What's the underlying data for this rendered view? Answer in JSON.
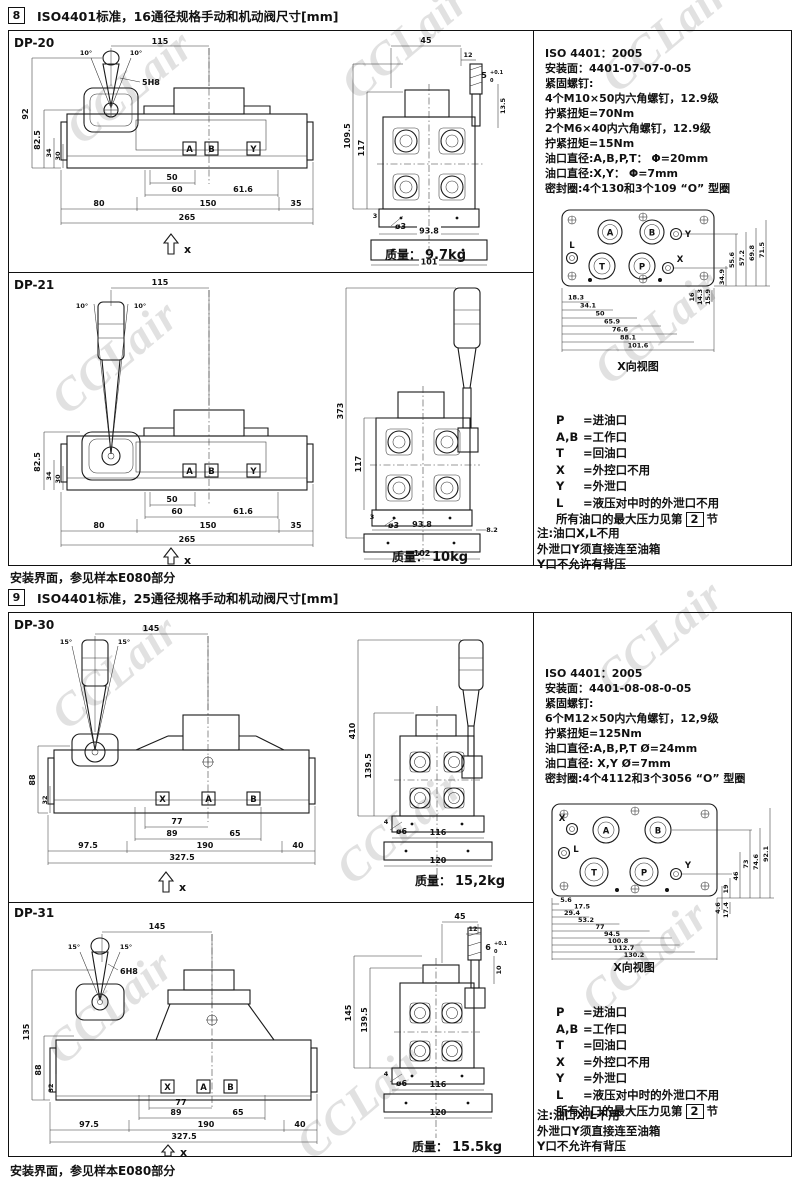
{
  "watermark": "CCLair",
  "sec8": {
    "num": "8",
    "title": "ISO4401标准，16通径规格手动和机动阀尺寸[mm]",
    "footer": "安装界面，参见样本E080部分",
    "spec": [
      "ISO 4401：2005",
      "安装面：4401-07-07-0-05",
      "紧固螺钉:",
      "4个M10×50内六角螺钉，12.9级",
      "拧紧扭矩=70Nm",
      "2个M6×40内六角螺钉，12.9级",
      "拧紧扭矩=15Nm",
      "油口直径:A,B,P,T： Φ=20mm",
      "油口直径:X,Y： Φ=7mm",
      "密封圈:4个130和3个109 “O” 型圈"
    ],
    "face": {
      "caption": "X向视图",
      "ports": [
        "L",
        "A",
        "B",
        "Y",
        "T",
        "P",
        "X"
      ],
      "hdims": [
        "18.3",
        "34.1",
        "50",
        "65.9",
        "76.6",
        "88.1",
        "101.6"
      ],
      "vdims": [
        "34.9",
        "55.6",
        "57.2",
        "69.8",
        "71.5"
      ],
      "vsmall": [
        "16",
        "14.3",
        "15.9"
      ]
    },
    "legend": {
      "rows": [
        {
          "k": "P",
          "v": "=进油口"
        },
        {
          "k": "A,B",
          "v": "=工作口"
        },
        {
          "k": "T",
          "v": "=回油口"
        },
        {
          "k": "X",
          "v": "=外控口不用"
        },
        {
          "k": "Y",
          "v": "=外泄口"
        },
        {
          "k": "L",
          "v": "=液压对中时的外泄口不用"
        }
      ],
      "max_pre": "所有油口的最大压力见第",
      "max_box": "2",
      "max_post": "节"
    },
    "note": [
      "注:油口X,L不用",
      "外泄口Y须直接连至油箱",
      "Y口不允许有背压"
    ],
    "dp20": {
      "label": "DP-20",
      "front": {
        "w115": "115",
        "a1": "10°",
        "a2": "10°",
        "pin": "5H8",
        "v92": "92",
        "v825": "82.5",
        "v34": "34",
        "v30": "30",
        "pA": "A",
        "pB": "B",
        "pY": "Y",
        "d50": "50",
        "d60": "60",
        "d616": "61.6",
        "d80": "80",
        "d150": "150",
        "d35": "35",
        "d265": "265",
        "x": "x"
      },
      "side": {
        "d45": "45",
        "d12": "12",
        "d5": "5",
        "tolt": "+0.1",
        "tolb": "0",
        "d135": "13.5",
        "v1095": "109.5",
        "v117": "117",
        "d3": "3",
        "phi": "ø3",
        "b938": "93.8",
        "b101": "101",
        "mass_label": "质量：",
        "mass": "9.7kg"
      }
    },
    "dp21": {
      "label": "DP-21",
      "front": {
        "w115": "115",
        "a1": "10°",
        "a2": "10°",
        "v825": "82.5",
        "v34": "34",
        "v30": "30",
        "pA": "A",
        "pB": "B",
        "pY": "Y",
        "d50": "50",
        "d60": "60",
        "d616": "61.6",
        "d80": "80",
        "d150": "150",
        "d35": "35",
        "d265": "265",
        "x": "x"
      },
      "side": {
        "v373": "373",
        "v117": "117",
        "d3": "3",
        "phi": "ø3",
        "b938": "93.8",
        "b82": "8.2",
        "b102": "102",
        "mass_label": "质量：",
        "mass": "10kg"
      }
    }
  },
  "sec9": {
    "num": "9",
    "title": "ISO4401标准，25通径规格手动和机动阀尺寸[mm]",
    "footer": "安装界面，参见样本E080部分",
    "spec": [
      "ISO 4401：2005",
      "安装面：4401-08-08-0-05",
      "紧固螺钉:",
      "6个M12×50内六角螺钉，12,9级",
      "拧紧扭矩=125Nm",
      "油口直径:A,B,P,T Ø=24mm",
      "油口直径: X,Y Ø=7mm",
      "密封圈:4个4112和3个3056 “O” 型圈"
    ],
    "face": {
      "caption": "X向视图",
      "ports": [
        "X",
        "A",
        "B",
        "L",
        "T",
        "P",
        "Y"
      ],
      "hdims": [
        "5.6",
        "17.5",
        "29.4",
        "53.2",
        "77",
        "94.5",
        "100.8",
        "112.7",
        "130.2"
      ],
      "vdims": [
        "19",
        "46",
        "73",
        "74.6",
        "92.1"
      ],
      "vsmall": [
        "4.6",
        "17.4"
      ]
    },
    "legend": {
      "rows": [
        {
          "k": "P",
          "v": "=进油口"
        },
        {
          "k": "A,B",
          "v": "=工作口"
        },
        {
          "k": "T",
          "v": "=回油口"
        },
        {
          "k": "X",
          "v": "=外控口不用"
        },
        {
          "k": "Y",
          "v": "=外泄口"
        },
        {
          "k": "L",
          "v": "=液压对中时的外泄口不用"
        }
      ],
      "max_pre": "所有油口的最大压力见第",
      "max_box": "2",
      "max_post": "节"
    },
    "note": [
      "注:油口X,L不用",
      "外泄口Y须直接连至油箱",
      "Y口不允许有背压"
    ],
    "dp30": {
      "label": "DP-30",
      "front": {
        "w145": "145",
        "a1": "15°",
        "a2": "15°",
        "v88": "88",
        "v32": "32",
        "pX": "X",
        "pA": "A",
        "pB": "B",
        "d77": "77",
        "d89": "89",
        "d65": "65",
        "d975": "97.5",
        "d190": "190",
        "d40": "40",
        "d3275": "327.5",
        "x": "x"
      },
      "side": {
        "v410": "410",
        "v1395": "139.5",
        "d4": "4",
        "phi": "ø6",
        "b116": "116",
        "b120": "120",
        "mass_label": "质量：",
        "mass": "15,2kg"
      }
    },
    "dp31": {
      "label": "DP-31",
      "front": {
        "w145": "145",
        "a1": "15°",
        "a2": "15°",
        "pin": "6H8",
        "v135": "135",
        "v88": "88",
        "v32": "32",
        "pX": "X",
        "pA": "A",
        "pB": "B",
        "d77": "77",
        "d89": "89",
        "d65": "65",
        "d975": "97.5",
        "d190": "190",
        "d40": "40",
        "d3275": "327.5",
        "x": "x"
      },
      "side": {
        "d45": "45",
        "d12": "12",
        "d6": "6",
        "tolt": "+0.1",
        "tolb": "0",
        "d10": "10",
        "v145": "145",
        "v1395": "139.5",
        "d4": "4",
        "phi": "ø6",
        "b116": "116",
        "b120": "120",
        "mass_label": "质量：",
        "mass": "15.5kg"
      }
    }
  }
}
